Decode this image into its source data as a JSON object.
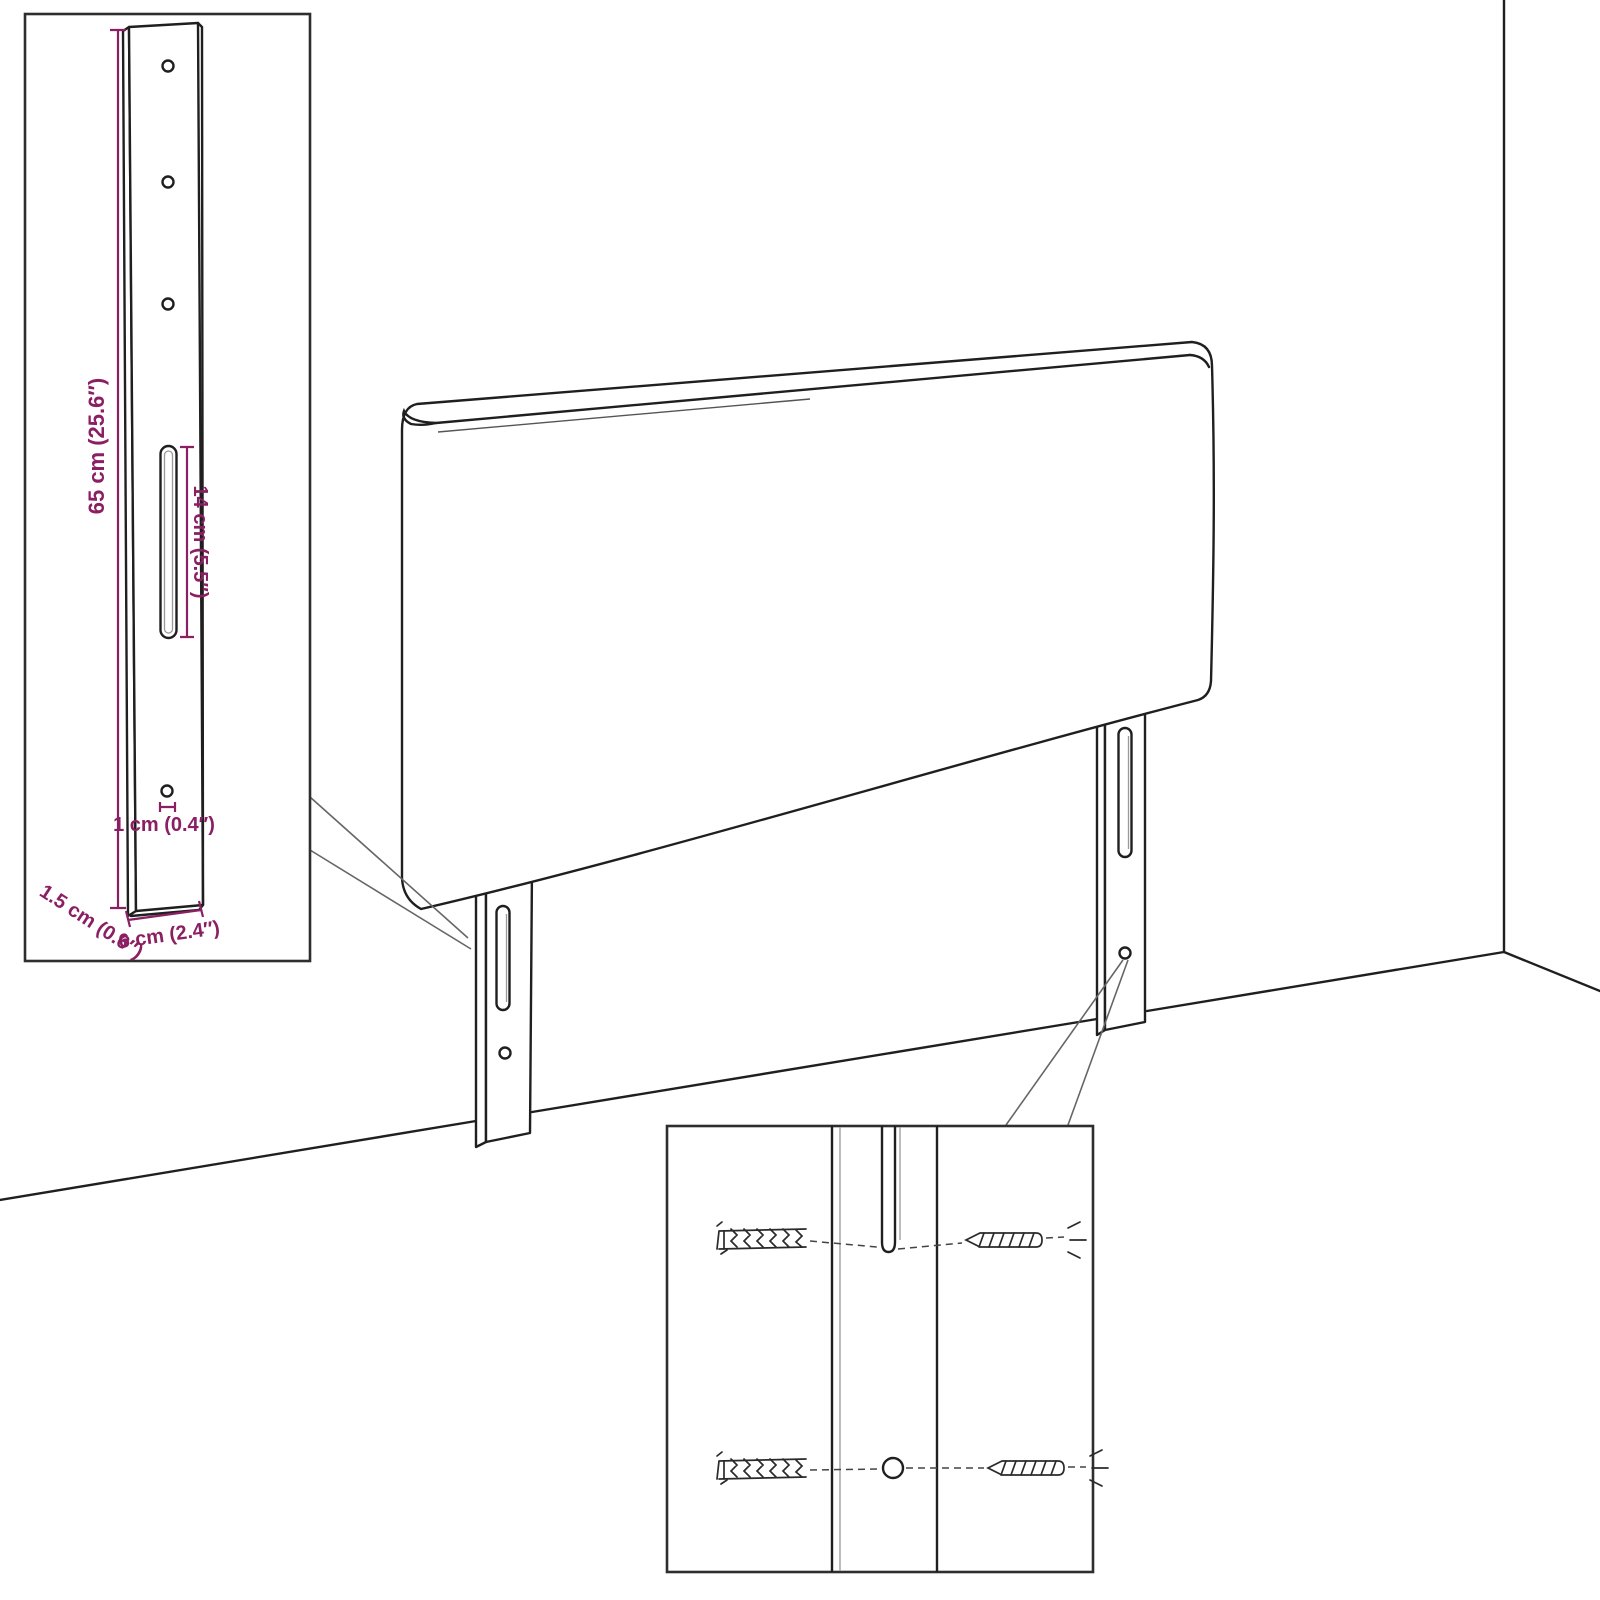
{
  "diagram": {
    "title": "headboard-mounting-dimension-diagram",
    "insets": {
      "bracket_detail": {
        "dimensions": {
          "height": "65 cm (25.6″)",
          "slot_length": "14 cm (5.5″)",
          "hole_diameter": "1 cm (0.4″)",
          "thickness": "1.5 cm (0.6″)",
          "width": "6 cm (2.4″)"
        }
      },
      "hardware_detail": {
        "icons": [
          "wall-plug-icon",
          "screw-icon"
        ]
      }
    },
    "colors": {
      "dimension_accent": "#8a1f63",
      "line_art": "#1f1f1f",
      "background": "#ffffff"
    }
  }
}
